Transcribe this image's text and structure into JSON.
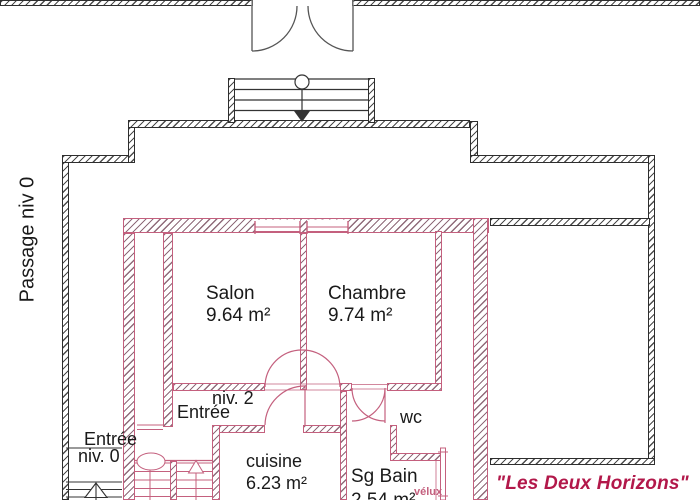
{
  "colors": {
    "pink": "#c4607e",
    "wall_black": "#2e2e2e",
    "brand": "#b2184a"
  },
  "labels": {
    "passage": "Passage niv 0",
    "salon_name": "Salon",
    "salon_area": "9.64 m²",
    "chambre_name": "Chambre",
    "chambre_area": "9.74 m²",
    "entree_niv2_line1": "niv. 2",
    "entree_niv2_line2": "Entrée",
    "entree_niv0_line1": "Entrée",
    "entree_niv0_line2": "niv. 0",
    "cuisine_name": "cuisine",
    "cuisine_area": "6.23 m²",
    "sgbain_name": "Sg Bain",
    "sgbain_area": "2.54 m²",
    "wc": "wc",
    "velux": "vélux",
    "brand": "\"Les Deux Horizons\""
  }
}
